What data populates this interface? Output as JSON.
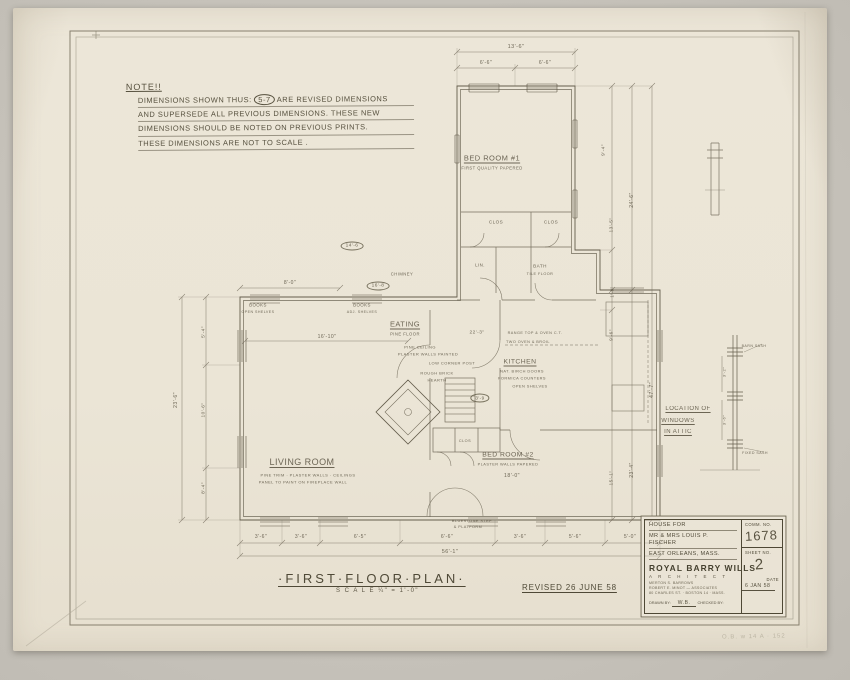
{
  "note": {
    "heading": "NOTE!!",
    "line1_pre": "DIMENSIONS SHOWN THUS:",
    "circled": "5-7",
    "line1_post": "ARE REVISED DIMENSIONS",
    "line2": "AND SUPERSEDE ALL PREVIOUS DIMENSIONS. THESE NEW",
    "line3": "DIMENSIONS SHOULD BE NOTED ON PREVIOUS PRINTS.",
    "line4": "THESE DIMENSIONS ARE NOT TO SCALE ."
  },
  "title": {
    "main": "·FIRST·FLOOR·PLAN·",
    "scale": "S C A L E   ¼\" = 1'-0\"",
    "revision": "REVISED 26 JUNE 58"
  },
  "title_block": {
    "project_line1": "HOUSE FOR",
    "project_line2": "MR & MRS LOUIS P. FISCHER",
    "project_line3": "EAST ORLEANS, MASS.",
    "firm_name": "ROYAL BARRY WILLS",
    "firm_title": "A R C H I T E C T",
    "firm_line1": "MERTON S. BARROWS",
    "firm_line2": "ROBERT E. MINOT — ASSOCIATES",
    "firm_line3": "80 CHARLES ST. · BOSTON 14 · MASS.",
    "drawn_by_label": "DRAWN BY:",
    "drawn_by": "W.B.",
    "checked_by_label": "CHECKED BY:",
    "comm_label": "COMM. NO.",
    "comm_no": "1678",
    "sheet_label": "SHEET NO.",
    "sheet_no": "2",
    "date_label": "DATE",
    "date": "6 JAN 58"
  },
  "scribble": "O.B. w 14 A · 152",
  "plan": {
    "labels": [
      {
        "t": "13'-6\"",
        "x": 516,
        "y": 47,
        "s": 5.5
      },
      {
        "t": "6'-6\"",
        "x": 486,
        "y": 63,
        "s": 5
      },
      {
        "t": "6'-6\"",
        "x": 545,
        "y": 63,
        "s": 5
      },
      {
        "t": "BED ROOM #1",
        "x": 492,
        "y": 158,
        "s": 7.5,
        "u": 1,
        "n": "room-label-bedroom1"
      },
      {
        "t": "FIRST QUALITY PAPERED",
        "x": 492,
        "y": 168,
        "s": 4.2
      },
      {
        "t": "9'-4\"",
        "x": 604,
        "y": 150,
        "s": 4.8,
        "r": -90
      },
      {
        "t": "13'-5\"",
        "x": 612,
        "y": 225,
        "s": 4.8,
        "r": -90
      },
      {
        "t": "24'-6\"",
        "x": 632,
        "y": 200,
        "s": 5,
        "r": -90
      },
      {
        "t": "1'-8\"",
        "x": 612,
        "y": 292,
        "s": 4.5,
        "r": -90
      },
      {
        "t": "9'-6\"",
        "x": 612,
        "y": 335,
        "s": 4.8,
        "r": -90
      },
      {
        "t": "47'-7\"",
        "x": 652,
        "y": 390,
        "s": 5.2,
        "r": -90
      },
      {
        "t": "15'-1\"",
        "x": 612,
        "y": 478,
        "s": 4.8,
        "r": -90
      },
      {
        "t": "23'-4\"",
        "x": 632,
        "y": 470,
        "s": 5,
        "r": -90
      },
      {
        "t": "CLOS",
        "x": 496,
        "y": 222,
        "s": 4.6
      },
      {
        "t": "CLOS",
        "x": 551,
        "y": 222,
        "s": 4.6
      },
      {
        "t": "LIN.",
        "x": 480,
        "y": 265,
        "s": 4.4
      },
      {
        "t": "BATH",
        "x": 540,
        "y": 266,
        "s": 4.6
      },
      {
        "t": "TILE FLOOR",
        "x": 540,
        "y": 274,
        "s": 3.8
      },
      {
        "t": "CHIMNEY",
        "x": 402,
        "y": 274,
        "s": 4.2
      },
      {
        "t": "14'-6",
        "x": 352,
        "y": 246,
        "s": 4.8,
        "circle": 1,
        "n": "revised-dimension"
      },
      {
        "t": "16'-8",
        "x": 378,
        "y": 286,
        "s": 4.8,
        "circle": 1,
        "n": "revised-dimension"
      },
      {
        "t": "8'-0\"",
        "x": 290,
        "y": 283,
        "s": 5
      },
      {
        "t": "BOOKS",
        "x": 258,
        "y": 305,
        "s": 4.4
      },
      {
        "t": "OPEN SHELVES",
        "x": 258,
        "y": 312,
        "s": 3.6
      },
      {
        "t": "BOOKS",
        "x": 362,
        "y": 305,
        "s": 4.4
      },
      {
        "t": "ADJ. SHELVES",
        "x": 362,
        "y": 312,
        "s": 3.6
      },
      {
        "t": "16'-10\"",
        "x": 327,
        "y": 337,
        "s": 5
      },
      {
        "t": "EATING",
        "x": 405,
        "y": 324,
        "s": 7.5,
        "u": 1,
        "n": "room-label-eating"
      },
      {
        "t": "PINE FLOOR",
        "x": 405,
        "y": 334,
        "s": 4.2
      },
      {
        "t": "22'-3\"",
        "x": 477,
        "y": 333,
        "s": 4.8
      },
      {
        "t": "PINE CEILING",
        "x": 420,
        "y": 347,
        "s": 4
      },
      {
        "t": "PLASTER WALLS PAINTED",
        "x": 428,
        "y": 354,
        "s": 4
      },
      {
        "t": "LOW CORNER POST",
        "x": 452,
        "y": 363,
        "s": 4
      },
      {
        "t": "ROUGH BRICK",
        "x": 437,
        "y": 373,
        "s": 4
      },
      {
        "t": "HEARTH",
        "x": 437,
        "y": 380,
        "s": 4
      },
      {
        "t": "RANGE TOP & OVEN C.T.",
        "x": 535,
        "y": 333,
        "s": 3.8
      },
      {
        "t": "TWO OVEN & BROIL",
        "x": 528,
        "y": 342,
        "s": 3.8
      },
      {
        "t": "KITCHEN",
        "x": 520,
        "y": 362,
        "s": 6.8,
        "u": 1,
        "n": "room-label-kitchen"
      },
      {
        "t": "NAT. BIRCH DOORS",
        "x": 522,
        "y": 371,
        "s": 3.9
      },
      {
        "t": "FORMICA COUNTERS",
        "x": 522,
        "y": 378,
        "s": 3.9
      },
      {
        "t": "OPEN SHELVES",
        "x": 530,
        "y": 386,
        "s": 3.9
      },
      {
        "t": "3'-9",
        "x": 480,
        "y": 398,
        "s": 4.6,
        "circle": 1,
        "n": "revised-dimension"
      },
      {
        "t": "LIVING ROOM",
        "x": 302,
        "y": 462,
        "s": 9,
        "u": 1,
        "n": "room-label-living"
      },
      {
        "t": "PINE TRIM · PLASTER WALLS · CEILINGS",
        "x": 308,
        "y": 475,
        "s": 4
      },
      {
        "t": "PANEL TO PAINT ON FIREPLACE WALL",
        "x": 303,
        "y": 482,
        "s": 4
      },
      {
        "t": "BED ROOM #2",
        "x": 508,
        "y": 455,
        "s": 6.8,
        "u": 1,
        "n": "room-label-bedroom2"
      },
      {
        "t": "PLASTER WALLS PAPERED",
        "x": 508,
        "y": 464,
        "s": 3.9
      },
      {
        "t": "18'-0\"",
        "x": 512,
        "y": 476,
        "s": 5.2
      },
      {
        "t": "CLOS",
        "x": 465,
        "y": 441,
        "s": 3.8
      },
      {
        "t": "23'-6\"",
        "x": 176,
        "y": 400,
        "s": 5.2,
        "r": -90
      },
      {
        "t": "5'-4\"",
        "x": 204,
        "y": 332,
        "s": 4.8,
        "r": -90
      },
      {
        "t": "10'-6\"",
        "x": 204,
        "y": 410,
        "s": 4.8,
        "r": -90
      },
      {
        "t": "8'-4\"",
        "x": 204,
        "y": 488,
        "s": 4.8,
        "r": -90
      },
      {
        "t": "BLUESTONE STEP",
        "x": 472,
        "y": 521,
        "s": 3.8
      },
      {
        "t": "& PLATFORM",
        "x": 468,
        "y": 527,
        "s": 3.8
      },
      {
        "t": "3'-6\"",
        "x": 261,
        "y": 537,
        "s": 5
      },
      {
        "t": "3'-6\"",
        "x": 301,
        "y": 537,
        "s": 5
      },
      {
        "t": "6'-5\"",
        "x": 360,
        "y": 537,
        "s": 5
      },
      {
        "t": "6'-6\"",
        "x": 447,
        "y": 537,
        "s": 5
      },
      {
        "t": "3'-6\"",
        "x": 520,
        "y": 537,
        "s": 5
      },
      {
        "t": "5'-6\"",
        "x": 575,
        "y": 537,
        "s": 5
      },
      {
        "t": "5'-0\"",
        "x": 630,
        "y": 537,
        "s": 5
      },
      {
        "t": "56'-1\"",
        "x": 450,
        "y": 552,
        "s": 5.4
      },
      {
        "t": "LOCATION OF",
        "x": 688,
        "y": 409,
        "s": 6,
        "u": 1,
        "n": "attic-note-line"
      },
      {
        "t": "WINDOWS",
        "x": 678,
        "y": 421,
        "s": 6,
        "u": 1,
        "n": "attic-note-line"
      },
      {
        "t": "IN ATTIC",
        "x": 678,
        "y": 432,
        "s": 6,
        "u": 1,
        "n": "attic-note-line"
      },
      {
        "t": "3'-2\"",
        "x": 724,
        "y": 372,
        "s": 4,
        "r": -90
      },
      {
        "t": "3'-6\"",
        "x": 724,
        "y": 420,
        "s": 4,
        "r": -90
      },
      {
        "t": "BARN SASH",
        "x": 754,
        "y": 346,
        "s": 3.6
      },
      {
        "t": "FIXED SASH",
        "x": 755,
        "y": 453,
        "s": 3.6
      }
    ]
  }
}
